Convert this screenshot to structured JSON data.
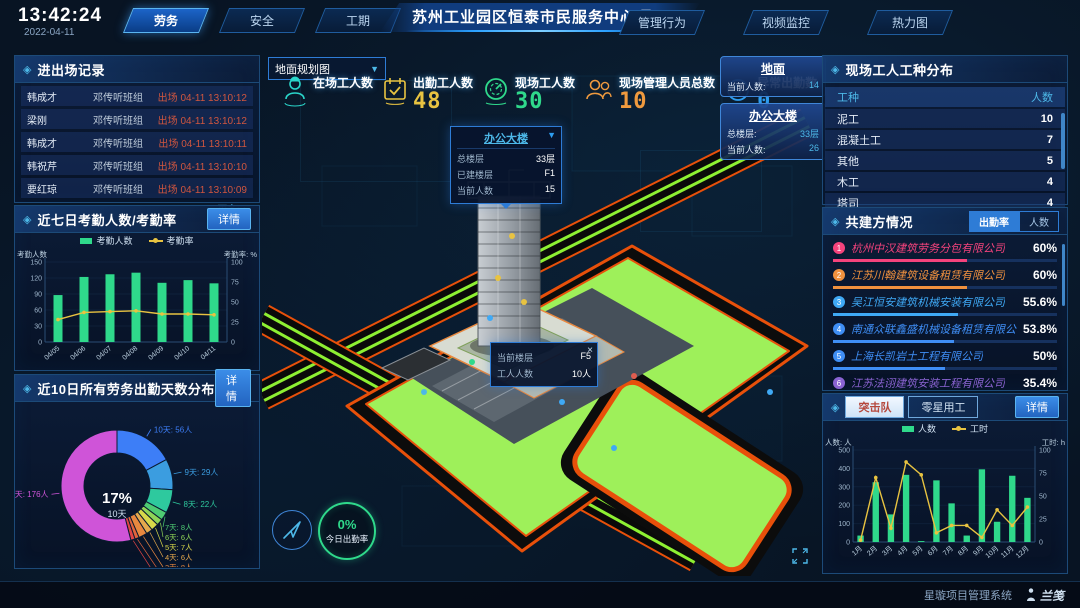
{
  "header": {
    "time": "13:42:24",
    "date": "2022-04-11",
    "left_tabs": [
      {
        "label": "劳务",
        "active": true
      },
      {
        "label": "安全",
        "active": false
      },
      {
        "label": "工期",
        "active": false
      }
    ],
    "title": "苏州工业园区恒泰市民服务中心项目",
    "right_tabs": [
      {
        "label": "管理行为",
        "active": false
      },
      {
        "label": "视频监控",
        "active": false
      },
      {
        "label": "热力图",
        "active": false
      }
    ]
  },
  "entry_exit": {
    "title": "进出场记录",
    "rows": [
      {
        "name": "韩成才",
        "team": "邓传听班组",
        "event": "出场 04-11 13:10:12"
      },
      {
        "name": "梁刚",
        "team": "邓传听班组",
        "event": "出场 04-11 13:10:12"
      },
      {
        "name": "韩成才",
        "team": "邓传听班组",
        "event": "出场 04-11 13:10:11"
      },
      {
        "name": "韩祝芹",
        "team": "邓传听班组",
        "event": "出场 04-11 13:10:10"
      },
      {
        "name": "要红琼",
        "team": "邓传听班组",
        "event": "出场 04-11 13:10:09"
      }
    ],
    "more_label": "更多>>"
  },
  "attendance7": {
    "title": "近七日考勤人数/考勤率",
    "detail_label": "详情",
    "chart_data": {
      "type": "bar+line",
      "categories": [
        "04/05",
        "04/06",
        "04/07",
        "04/08",
        "04/09",
        "04/10",
        "04/11"
      ],
      "series": [
        {
          "name": "考勤人数",
          "kind": "bar",
          "axis": "left",
          "color": "#2fd98b",
          "values": [
            88,
            122,
            127,
            130,
            111,
            116,
            110
          ]
        },
        {
          "name": "考勤率",
          "kind": "line",
          "axis": "right",
          "color": "#e8c341",
          "values": [
            28,
            37,
            38,
            39,
            35,
            35,
            34
          ]
        }
      ],
      "left_axis": {
        "title": "考勤人数",
        "min": 0,
        "max": 150,
        "step": 30
      },
      "right_axis": {
        "title": "考勤率: %",
        "min": 0,
        "max": 100,
        "step": 25
      }
    }
  },
  "distribution10": {
    "title": "近10日所有劳务出勤天数分布",
    "detail_label": "详情",
    "chart_data": {
      "type": "donut",
      "center_value": "17%",
      "center_label": "10天",
      "unit": "人",
      "slices": [
        {
          "label": "10天",
          "count": 56,
          "color": "#3d7ef7"
        },
        {
          "label": "9天",
          "count": 29,
          "color": "#3b9de0"
        },
        {
          "label": "8天",
          "count": 22,
          "color": "#2ec99e"
        },
        {
          "label": "7天",
          "count": 8,
          "color": "#4ecb73"
        },
        {
          "label": "6天",
          "count": 6,
          "color": "#8fd457"
        },
        {
          "label": "5天",
          "count": 7,
          "color": "#d7d84a"
        },
        {
          "label": "4天",
          "count": 6,
          "color": "#e5a94d"
        },
        {
          "label": "3天",
          "count": 8,
          "color": "#e8883f"
        },
        {
          "label": "2天",
          "count": 4,
          "color": "#e2643c"
        },
        {
          "label": "1天",
          "count": 4,
          "color": "#e04545"
        },
        {
          "label": "0天",
          "count": 176,
          "color": "#cf54d8"
        }
      ]
    }
  },
  "map": {
    "layer_select": "地面规划图",
    "stats": [
      {
        "label": "在场工人数",
        "value": "",
        "icon": "worker-icon",
        "color": "#2ad5c9"
      },
      {
        "label": "出勤工人数",
        "value": "48",
        "icon": "calendar-check-icon",
        "color": "#e8c341"
      },
      {
        "label": "现场工人数",
        "value": "30",
        "icon": "gauge-icon",
        "color": "#2fd98b"
      },
      {
        "label": "现场管理人员总数",
        "value": "10",
        "icon": "people-icon",
        "color": "#f09a3e"
      },
      {
        "label": "异常出勤数",
        "value": "0",
        "icon": "pulse-icon",
        "color": "#2e9df0"
      }
    ],
    "building_popup": {
      "title": "办公大楼",
      "rows": [
        [
          "总楼层",
          "33层"
        ],
        [
          "已建楼层",
          "F1"
        ],
        [
          "当前人数",
          "15"
        ]
      ]
    },
    "floor_popup": {
      "rows": [
        [
          "当前楼层",
          "F5"
        ],
        [
          "工人人数",
          "10人"
        ]
      ],
      "close_label": "×"
    },
    "side_cards": [
      {
        "title": "地面",
        "rows": [
          [
            "当前人数:",
            "14"
          ]
        ]
      },
      {
        "title": "办公大楼",
        "rows": [
          [
            "总楼层:",
            "33层"
          ],
          [
            "当前人数:",
            "26"
          ]
        ]
      }
    ],
    "gauge": {
      "value": "0%",
      "label": "今日出勤率"
    }
  },
  "worker_types": {
    "title": "现场工人工种分布",
    "headers": [
      "工种",
      "人数"
    ],
    "rows": [
      [
        "泥工",
        "10"
      ],
      [
        "混凝土工",
        "7"
      ],
      [
        "其他",
        "5"
      ],
      [
        "木工",
        "4"
      ],
      [
        "塔司",
        "4"
      ]
    ]
  },
  "partners": {
    "title": "共建方情况",
    "tabs": [
      {
        "label": "出勤率",
        "active": true
      },
      {
        "label": "人数",
        "active": false
      }
    ],
    "items": [
      {
        "rank": "1",
        "name": "杭州中汉建筑劳务分包有限公司",
        "value": "60%",
        "pct": 60,
        "color": "#f5437c"
      },
      {
        "rank": "2",
        "name": "江苏川翰建筑设备租赁有限公司",
        "value": "60%",
        "pct": 60,
        "color": "#f0913e"
      },
      {
        "rank": "3",
        "name": "吴江恒安建筑机械安装有限公司",
        "value": "55.6%",
        "pct": 55.6,
        "color": "#3fa9f5"
      },
      {
        "rank": "4",
        "name": "南通众联鑫盛机械设备租赁有限公司",
        "value": "53.8%",
        "pct": 53.8,
        "color": "#3f8ef5"
      },
      {
        "rank": "5",
        "name": "上海长凯岩土工程有限公司",
        "value": "50%",
        "pct": 50,
        "color": "#3f8ef5"
      },
      {
        "rank": "6",
        "name": "江苏法诩建筑安装工程有限公司",
        "value": "35.4%",
        "pct": 35.4,
        "color": "#8a63d2"
      }
    ]
  },
  "squad": {
    "tabs": [
      {
        "label": "突击队",
        "active": true
      },
      {
        "label": "零星用工",
        "active": false
      }
    ],
    "detail_label": "详情",
    "chart_data": {
      "type": "bar+line",
      "categories": [
        "1月",
        "2月",
        "3月",
        "4月",
        "5月",
        "6月",
        "7月",
        "8月",
        "9月",
        "10月",
        "11月",
        "12月"
      ],
      "series": [
        {
          "name": "人数",
          "kind": "bar",
          "axis": "left",
          "color": "#2fd98b",
          "values": [
            35,
            325,
            150,
            365,
            5,
            335,
            210,
            35,
            395,
            110,
            360,
            240
          ]
        },
        {
          "name": "工时",
          "kind": "line",
          "axis": "right",
          "color": "#e8c341",
          "values": [
            2,
            70,
            15,
            87,
            73,
            10,
            18,
            18,
            5,
            35,
            18,
            38
          ]
        }
      ],
      "left_axis": {
        "title": "人数: 人",
        "min": 0,
        "max": 500,
        "step": 100
      },
      "right_axis": {
        "title": "工时: h",
        "min": 0,
        "max": 100,
        "step": 25
      }
    }
  },
  "footer": {
    "brand": "星璇项目管理系统",
    "logo": "兰笺"
  }
}
